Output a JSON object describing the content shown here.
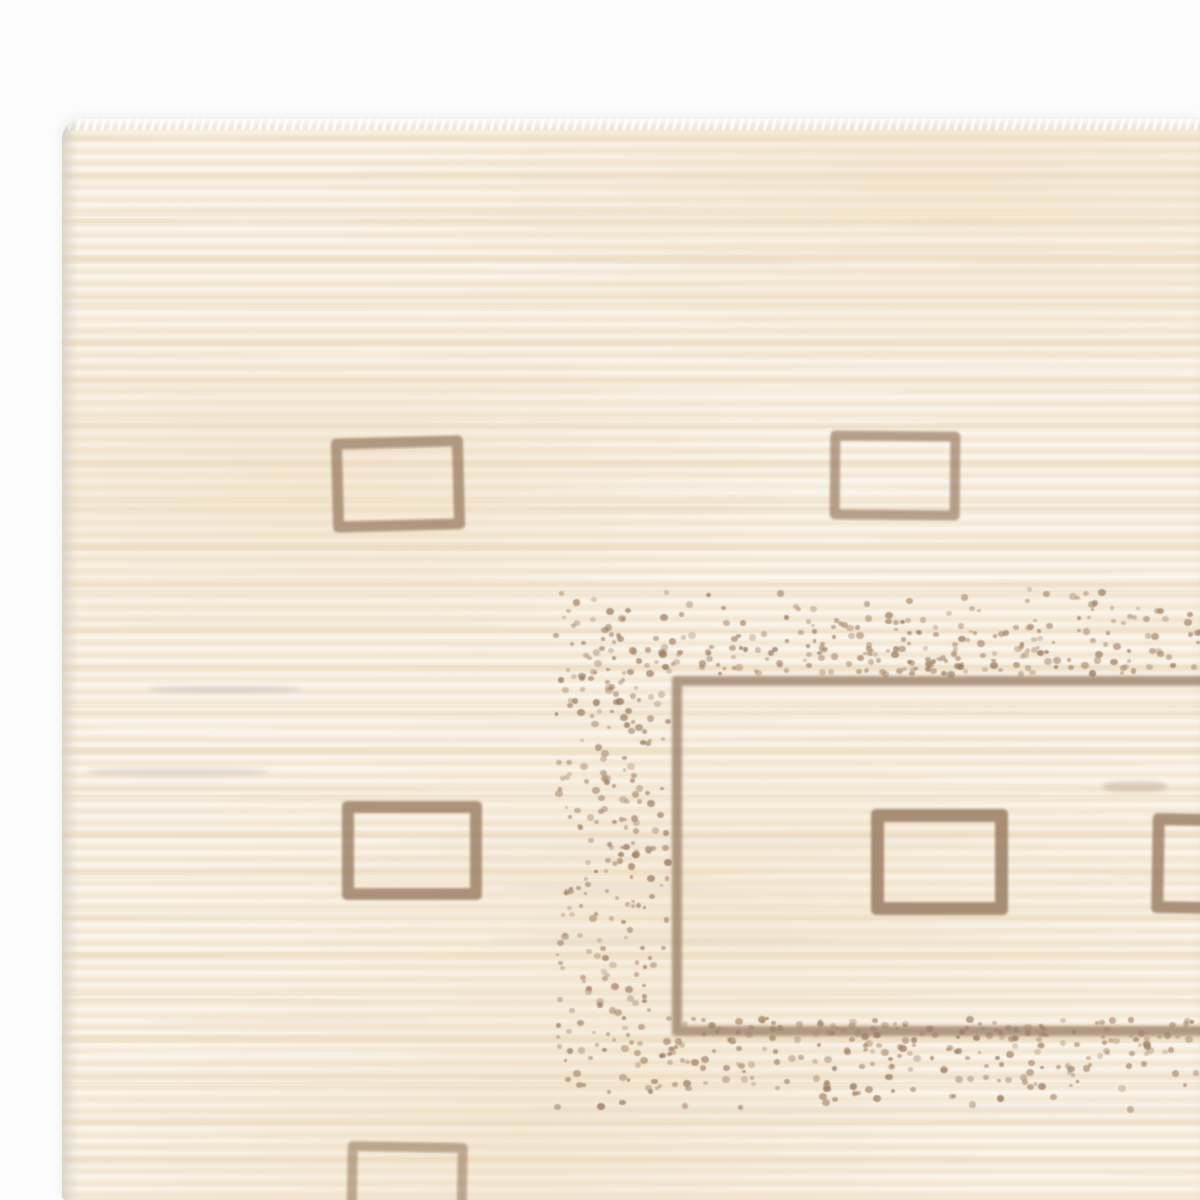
{
  "scene": {
    "type": "photograph",
    "subject": "Corner of a handwoven cream wool rug with brown open-square motifs, a stippled dot border band and a thin brown inner-field rectangle, on a white backdrop",
    "background_color": "#fcfcfc"
  },
  "palette": {
    "background": "#fcfcfc",
    "field_base": "#f1e6d2",
    "field_light": "#f9f3e7",
    "field_warm": "#ecd9bc",
    "edge_shadow": "#cfc8bf",
    "fringe_white": "#ffffff",
    "motif_brown": "#97795f",
    "line_brown": "#9c8068",
    "dot_brown": "#a8886a",
    "smudge_gray": "#c8c2bd"
  },
  "rug": {
    "left": 62,
    "top": 118,
    "corner_radius": 22
  },
  "inner_rectangle": {
    "x": 672,
    "y": 676,
    "width": 640,
    "height": 340,
    "stroke": 10,
    "opacity": 0.78,
    "blur": 1.6
  },
  "squares": [
    {
      "x": 332,
      "y": 437,
      "width": 110,
      "height": 72,
      "stroke": 11,
      "rotate": -1.5,
      "opacity": 0.72
    },
    {
      "x": 830,
      "y": 431,
      "width": 110,
      "height": 69,
      "stroke": 10,
      "rotate": 0.5,
      "opacity": 0.68
    },
    {
      "x": 342,
      "y": 801,
      "width": 116,
      "height": 75,
      "stroke": 12,
      "rotate": 0,
      "opacity": 0.78
    },
    {
      "x": 871,
      "y": 809,
      "width": 111,
      "height": 80,
      "stroke": 13,
      "rotate": 0,
      "opacity": 0.82
    },
    {
      "x": 347,
      "y": 1142,
      "width": 100,
      "height": 75,
      "stroke": 10,
      "rotate": 1,
      "opacity": 0.58
    },
    {
      "x": 1152,
      "y": 814,
      "width": 95,
      "height": 76,
      "stroke": 12,
      "rotate": 1,
      "opacity": 0.78
    }
  ],
  "smudges": [
    {
      "x": 1103,
      "y": 781,
      "width": 64,
      "height": 11,
      "color": "line_brown",
      "opacity": 0.28
    },
    {
      "x": 150,
      "y": 686,
      "width": 150,
      "height": 7,
      "color": "smudge_gray",
      "opacity": 0.55
    },
    {
      "x": 88,
      "y": 768,
      "width": 180,
      "height": 8,
      "color": "smudge_gray",
      "opacity": 0.45
    }
  ],
  "stipple_bands": [
    {
      "name": "top",
      "x": 553,
      "y": 586,
      "width": 647,
      "height": 86,
      "bias": "down",
      "count": 290
    },
    {
      "name": "left",
      "x": 553,
      "y": 672,
      "width": 112,
      "height": 436,
      "bias": "none",
      "count": 235
    },
    {
      "name": "bottom",
      "x": 665,
      "y": 1016,
      "width": 535,
      "height": 92,
      "bias": "up",
      "count": 250
    }
  ],
  "dots": {
    "seed": 7,
    "min_size": 3.5,
    "max_size": 8,
    "blur": 0.6
  },
  "texture": {
    "streak_count": 85,
    "streak_seed": 11
  }
}
